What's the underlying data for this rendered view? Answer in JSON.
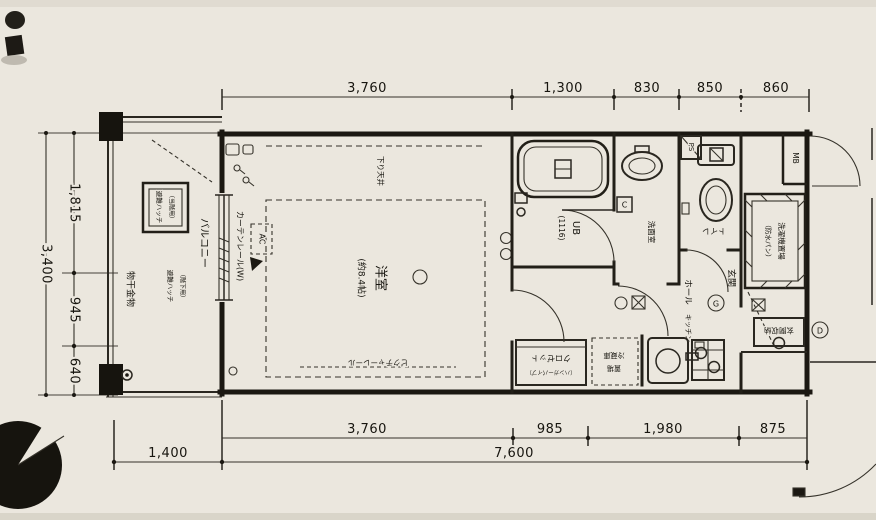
{
  "plan": {
    "dimensions": {
      "top": [
        "3,760",
        "1,300",
        "830",
        "850",
        "860"
      ],
      "left_total": "3,400",
      "left_segments": [
        "1,815",
        "945",
        "640"
      ],
      "bottom_segments": [
        "3,760",
        "985",
        "1,980",
        "875"
      ],
      "bottom_left": "1,400",
      "bottom_total": "7,600"
    },
    "rooms": {
      "balcony": "バルコニー",
      "western_room": "洋室",
      "western_room_size": "(約8.4帖)",
      "unit_bath": "UB",
      "unit_bath_size": "(1116)",
      "washroom": "洗面室",
      "toilet": "トイレ",
      "hall": "ホール",
      "kitchen": "キッチン",
      "entrance": "玄関",
      "closet": "クロゼット",
      "closet_note": "（ハンガーパイプ）",
      "fridge_space_line1": "冷蔵庫",
      "fridge_space_line2": "置場",
      "washer_space": "洗濯機置場",
      "washer_space_note": "（防水パン）",
      "entrance_storage": "玄関収納"
    },
    "annotations": {
      "evac_hatch": "避難ハッチ",
      "evac_hatch_note": "（当階用）",
      "evac_hatch_below": "避難ハッチ",
      "evac_hatch_below_note": "（階下用）",
      "laundry_bracket": "物干金物",
      "curtain_rail": "カーテンレール(W)",
      "air_conditioner": "AC",
      "dropped_ceiling": "下り天井",
      "picture_rail": "ピクチャーレール",
      "pipe_space": "PS",
      "meter_box": "MB",
      "gas_mark": "G",
      "door_mark": "D",
      "outlet_mark": "C"
    },
    "colors": {
      "paper": "#ebe7de",
      "ink": "#1b1812"
    }
  }
}
